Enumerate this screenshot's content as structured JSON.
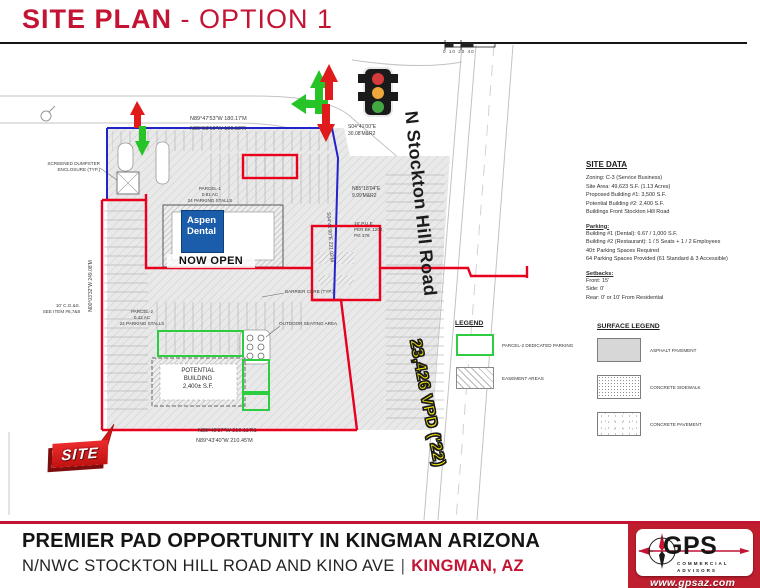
{
  "header": {
    "title_bold": "SITE PLAN",
    "title_rest": " - OPTION 1"
  },
  "colors": {
    "accent_red": "#c41433",
    "boundary_red": "#e8001d",
    "boundary_blue": "#2323cc",
    "parking_green": "#2ecc40",
    "vpd_yellow": "#fdee00",
    "aspen_blue": "#1b5cab"
  },
  "plan": {
    "road_label": "N Stockton Hill Road",
    "vpd_label": "23,426 VPD ('22)",
    "site_tag": "SITE",
    "aspen_line1": "Aspen",
    "aspen_line2": "Dental",
    "now_open": "NOW OPEN",
    "potential_building": "POTENTIAL\nBUILDING\n2,400± S.F.",
    "parcel1": "PARCEL-1\n0.81 AC\n24 PARKING STALLS",
    "parcel2": "PARCEL-2\n0.42 AC\n24 PARKING STALLS",
    "scale_ticks": "0   10   20            40",
    "dims": {
      "top1": "N89°47'53\"W 180.17'M",
      "top2": "N89°58'10\"W 180.52'R",
      "jog": "S04°41'00\"E\n30.08'M&R2",
      "east1": "N85°18'04\"E\n9.99'M&R2",
      "pue": "16' P.U.E.\nPER BK 1202,\nPG 376",
      "east2": "S04°41'00\"E 221.02'M",
      "west": "N00°03'32\"W 249.08'M",
      "bottom1": "N89°49'37\"W 210.11'R1",
      "bottom2": "N89°43'40\"W 210.45'M",
      "cgs": "10' C.G.&S.\nSEE ITEM #6,7&8",
      "dumpster": "SCREENED DUMPSTER\nENCLOSURE (TYP.)",
      "barrier": "BARRIER CURB (TYP.)",
      "seating": "OUTDOOR SEATING AREA"
    }
  },
  "site_data": {
    "title": "SITE DATA",
    "general": "Zoning: C-3 (Service Business)\nSite Area: 49,623 S.F. (1.13 Acres)\nProposed Building #1: 3,500 S.F.\nPotential Building #2: 2,400 S.F.\nBuildings Front Stockton Hill Road",
    "parking_title": "Parking:",
    "parking": "Building #1 (Dental):  6.67 / 1,000 S.F.\nBuilding #2 (Restaurant):  1 / 5 Seats + 1 / 2 Employees\n40± Parking Spaces Required\n64 Parking Spaces Provided (61 Standard & 3 Accessible)",
    "setbacks_title": "Setbacks:",
    "setbacks": "Front:  15'\nSide:  0'\nRear:  0' or 10' From Residential"
  },
  "legend": {
    "title": "LEGEND",
    "item1_label": "PARCEL-2 DEDICATED PARKING",
    "item2_label": "EASEMENT AREAS"
  },
  "surface_legend": {
    "title": "SURFACE LEGEND",
    "item1_label": "ASPHALT PAVEMENT",
    "item2_label": "CONCRETE SIDEWALK",
    "item3_label": "CONCRETE PAVEMENT"
  },
  "footer": {
    "line1": "PREMIER PAD OPPORTUNITY IN KINGMAN ARIZONA",
    "line2": "N/NWC STOCKTON HILL ROAD AND KINO AVE",
    "separator": "|",
    "city": "KINGMAN, AZ",
    "logo": {
      "name": "GPS",
      "sub": "COMMERCIAL\nADVISORS",
      "url": "www.gpsaz.com"
    }
  }
}
